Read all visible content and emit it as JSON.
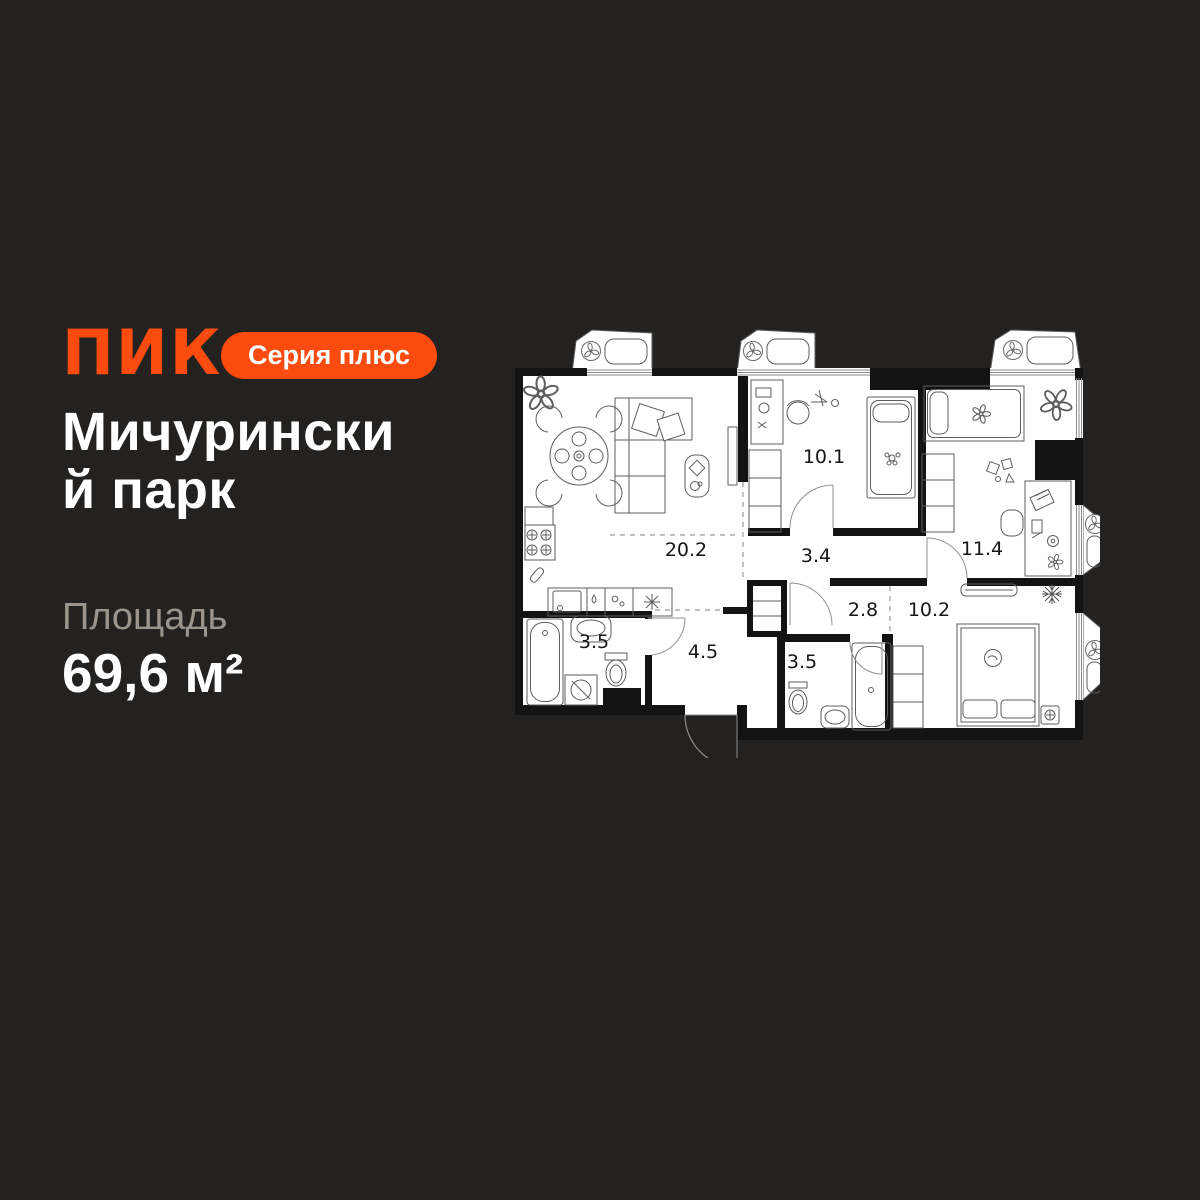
{
  "brand": {
    "logo_text": "ПИК",
    "badge_label": "Серия плюс"
  },
  "listing": {
    "title_line1": "Мичурински",
    "title_line2": "й парк",
    "area_label": "Площадь",
    "area_value": "69,6 м²"
  },
  "floorplan": {
    "rooms": [
      "20.2",
      "10.1",
      "3.4",
      "11.4",
      "2.8",
      "10.2",
      "3.5",
      "4.5",
      "3.5"
    ]
  },
  "colors": {
    "background": "#232220",
    "accent": "#FB4B0E",
    "text_primary": "#FFFFFF",
    "text_muted": "#9B948C",
    "plan_background": "#FFFFFF",
    "plan_walls": "#131313"
  }
}
